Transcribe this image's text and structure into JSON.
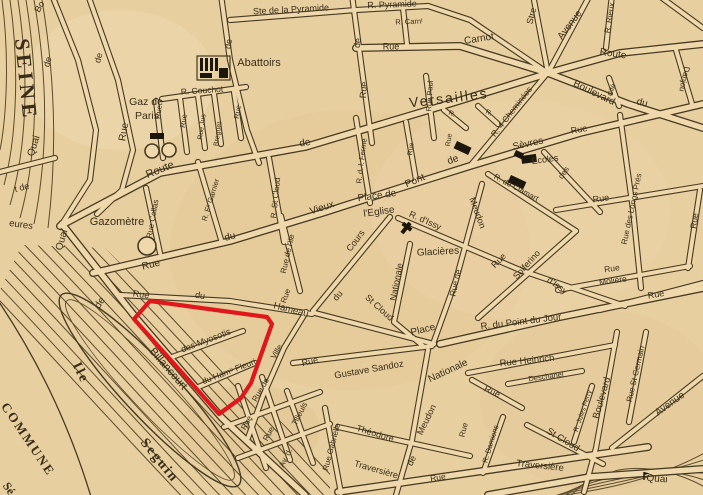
{
  "map": {
    "type": "vintage-street-map",
    "palette": {
      "paper": "#e8cfa0",
      "paper_light": "#efd9ac",
      "ink": "#473a22",
      "label_ink": "#382d18",
      "water_line": "#5b4a2c",
      "highlight_red": "#e0181c",
      "building_black": "#1c170d"
    },
    "highlight": {
      "purpose": "highlighted-parcel",
      "points": [
        [
          150,
          301
        ],
        [
          267,
          317
        ],
        [
          272,
          324
        ],
        [
          251,
          383
        ],
        [
          241,
          398
        ],
        [
          219,
          414
        ],
        [
          134,
          319
        ]
      ]
    },
    "labels": [
      {
        "t": "SEINE",
        "x": 24,
        "y": 80,
        "r": 84,
        "s": 21,
        "f": "serif",
        "b": 1,
        "ls": 4
      },
      {
        "t": "Bo",
        "x": 40,
        "y": 7,
        "r": -60,
        "s": 9
      },
      {
        "t": "de",
        "x": 48,
        "y": 62,
        "r": -74,
        "s": 9
      },
      {
        "t": "Quai",
        "x": 34,
        "y": 146,
        "r": -72,
        "s": 10
      },
      {
        "t": "de",
        "x": 99,
        "y": 58,
        "r": -74,
        "s": 9
      },
      {
        "t": "Rue",
        "x": 124,
        "y": 132,
        "r": -80,
        "s": 10
      },
      {
        "t": "t de",
        "x": 22,
        "y": 188,
        "r": -14,
        "s": 9
      },
      {
        "t": "eures",
        "x": 21,
        "y": 225,
        "r": 8,
        "s": 9.5
      },
      {
        "t": "Quai",
        "x": 62,
        "y": 240,
        "r": -74,
        "s": 10
      },
      {
        "t": "de",
        "x": 100,
        "y": 303,
        "r": -56,
        "s": 10
      },
      {
        "t": "Billancourt",
        "x": 168,
        "y": 369,
        "r": 49,
        "s": 11
      },
      {
        "t": "Ile",
        "x": 80,
        "y": 373,
        "r": 64,
        "s": 14,
        "f": "serif",
        "b": 1,
        "ls": 2
      },
      {
        "t": "Seguin",
        "x": 159,
        "y": 461,
        "r": 51,
        "s": 14,
        "f": "serif",
        "b": 1,
        "ls": 2
      },
      {
        "t": "COMMUNE",
        "x": 27,
        "y": 440,
        "r": 56,
        "s": 13,
        "f": "serif",
        "b": 1,
        "ls": 2
      },
      {
        "t": "Sé",
        "x": 8,
        "y": 489,
        "r": 56,
        "s": 12,
        "f": "serif",
        "b": 1
      },
      {
        "t": "Gaz de",
        "x": 146,
        "y": 102,
        "r": 0,
        "s": 10.5
      },
      {
        "t": "Paris",
        "x": 147,
        "y": 116,
        "r": 0,
        "s": 10.5
      },
      {
        "t": "Gazomètre",
        "x": 117,
        "y": 222,
        "r": 0,
        "s": 11
      },
      {
        "t": "R. Couchot",
        "x": 202,
        "y": 91,
        "r": -4,
        "s": 8.5
      },
      {
        "t": "Rue",
        "x": 159,
        "y": 112,
        "r": -82,
        "s": 7.5
      },
      {
        "t": "Rue",
        "x": 184,
        "y": 121,
        "r": -82,
        "s": 7.5
      },
      {
        "t": "Rue Jus",
        "x": 202,
        "y": 127,
        "r": -82,
        "s": 7
      },
      {
        "t": "Breguet",
        "x": 218,
        "y": 134,
        "r": -82,
        "s": 7
      },
      {
        "t": "Rue",
        "x": 238,
        "y": 112,
        "r": -82,
        "s": 7.5
      },
      {
        "t": "Abattoirs",
        "x": 259,
        "y": 63,
        "r": 0,
        "s": 11
      },
      {
        "t": "de",
        "x": 229,
        "y": 44,
        "r": -82,
        "s": 9
      },
      {
        "t": "Ste de la Pyramide",
        "x": 291,
        "y": 10,
        "r": -3,
        "s": 9
      },
      {
        "t": "R. Pyramide",
        "x": 392,
        "y": 5,
        "r": -2,
        "s": 9
      },
      {
        "t": "R. Carnᵗ",
        "x": 409,
        "y": 22,
        "r": -2,
        "s": 7.5
      },
      {
        "t": "Rue",
        "x": 391,
        "y": 47,
        "r": 0,
        "s": 9
      },
      {
        "t": "Carnot",
        "x": 479,
        "y": 39,
        "r": -9,
        "s": 10
      },
      {
        "t": "de",
        "x": 358,
        "y": 43,
        "r": -82,
        "s": 9
      },
      {
        "t": "Rue",
        "x": 364,
        "y": 90,
        "r": -86,
        "s": 9
      },
      {
        "t": "Rue Paul",
        "x": 430,
        "y": 96,
        "r": -87,
        "s": 7.5
      },
      {
        "t": "Versailles",
        "x": 449,
        "y": 99,
        "r": -7,
        "s": 14,
        "ls": 2
      },
      {
        "t": "Route",
        "x": 160,
        "y": 170,
        "r": -22,
        "s": 11
      },
      {
        "t": "de",
        "x": 305,
        "y": 143,
        "r": -9,
        "s": 10
      },
      {
        "t": "Stre",
        "x": 532,
        "y": 16,
        "r": -76,
        "s": 9
      },
      {
        "t": "Avenue",
        "x": 570,
        "y": 25,
        "r": -53,
        "s": 10
      },
      {
        "t": "R. Rieux",
        "x": 610,
        "y": 18,
        "r": -81,
        "s": 8
      },
      {
        "t": "Route",
        "x": 613,
        "y": 54,
        "r": 8,
        "s": 10
      },
      {
        "t": "Boulevard",
        "x": 594,
        "y": 93,
        "r": 26,
        "s": 10
      },
      {
        "t": "du",
        "x": 642,
        "y": 103,
        "r": 15,
        "s": 10
      },
      {
        "t": "Cité",
        "x": 612,
        "y": 90,
        "r": -72,
        "s": 7
      },
      {
        "t": "Danjou",
        "x": 684,
        "y": 79,
        "r": 102,
        "s": 8
      },
      {
        "t": "R. 4 Cheminées",
        "x": 512,
        "y": 112,
        "r": -52,
        "s": 8.5
      },
      {
        "t": "Sèvres",
        "x": 528,
        "y": 144,
        "r": -12,
        "s": 10
      },
      {
        "t": "Rue",
        "x": 579,
        "y": 130,
        "r": -10,
        "s": 9
      },
      {
        "t": "des",
        "x": 564,
        "y": 173,
        "r": -56,
        "s": 8
      },
      {
        "t": "Ecoles",
        "x": 545,
        "y": 160,
        "r": -8,
        "s": 9
      },
      {
        "t": "R. de Clamart",
        "x": 516,
        "y": 188,
        "r": 28,
        "s": 8
      },
      {
        "t": "R. d. l. Ferme",
        "x": 362,
        "y": 161,
        "r": -83,
        "s": 7.5
      },
      {
        "t": "Rue",
        "x": 411,
        "y": 149,
        "r": -83,
        "s": 7
      },
      {
        "t": "R.",
        "x": 452,
        "y": 114,
        "r": 25,
        "s": 7
      },
      {
        "t": "R.",
        "x": 489,
        "y": 113,
        "r": 25,
        "s": 7
      },
      {
        "t": "Rue",
        "x": 449,
        "y": 140,
        "r": -81,
        "s": 7
      },
      {
        "t": "Place de",
        "x": 377,
        "y": 196,
        "r": -8,
        "s": 10
      },
      {
        "t": "l'Eglise",
        "x": 379,
        "y": 212,
        "r": -8,
        "s": 10
      },
      {
        "t": "Vieux",
        "x": 322,
        "y": 208,
        "r": -18,
        "s": 10
      },
      {
        "t": "Pont",
        "x": 415,
        "y": 181,
        "r": -23,
        "s": 10
      },
      {
        "t": "de",
        "x": 453,
        "y": 160,
        "r": -20,
        "s": 10
      },
      {
        "t": "Rue",
        "x": 151,
        "y": 265,
        "r": -13,
        "s": 10
      },
      {
        "t": "du",
        "x": 230,
        "y": 237,
        "r": -14,
        "s": 10
      },
      {
        "t": "R. St Cloud",
        "x": 276,
        "y": 198,
        "r": -84,
        "s": 8
      },
      {
        "t": "Rue Collas",
        "x": 153,
        "y": 219,
        "r": -80,
        "s": 8
      },
      {
        "t": "R. Fˢ Garnier",
        "x": 211,
        "y": 200,
        "r": -73,
        "s": 7.5
      },
      {
        "t": "Rue de l'Ile",
        "x": 288,
        "y": 254,
        "r": -77,
        "s": 8
      },
      {
        "t": "du",
        "x": 338,
        "y": 296,
        "r": -50,
        "s": 9
      },
      {
        "t": "Cours",
        "x": 356,
        "y": 241,
        "r": -53,
        "s": 9
      },
      {
        "t": "Rue",
        "x": 141,
        "y": 295,
        "r": 8,
        "s": 9
      },
      {
        "t": "du",
        "x": 200,
        "y": 296,
        "r": 8,
        "s": 9
      },
      {
        "t": "Hameau",
        "x": 291,
        "y": 310,
        "r": 14,
        "s": 9.5
      },
      {
        "t": "Rue",
        "x": 286,
        "y": 296,
        "r": -70,
        "s": 8
      },
      {
        "t": "des Myosotis",
        "x": 206,
        "y": 341,
        "r": -21,
        "s": 9
      },
      {
        "t": "du Hamᵘ Fleuri",
        "x": 229,
        "y": 372,
        "r": -21,
        "s": 8.5
      },
      {
        "t": "Ville",
        "x": 277,
        "y": 352,
        "r": -60,
        "s": 8
      },
      {
        "t": "Rue de",
        "x": 261,
        "y": 390,
        "r": -60,
        "s": 8
      },
      {
        "t": "St Cloud",
        "x": 379,
        "y": 308,
        "r": 42,
        "s": 9
      },
      {
        "t": "Rue",
        "x": 310,
        "y": 362,
        "r": -14,
        "s": 9
      },
      {
        "t": "Gustave Sandoz",
        "x": 369,
        "y": 370,
        "r": -10,
        "s": 9.5
      },
      {
        "t": "Place",
        "x": 423,
        "y": 330,
        "r": -14,
        "s": 10
      },
      {
        "t": "Nationale",
        "x": 448,
        "y": 371,
        "r": -25,
        "s": 10
      },
      {
        "t": "Nationale",
        "x": 397,
        "y": 282,
        "r": -79,
        "s": 9
      },
      {
        "t": "Glacières",
        "x": 438,
        "y": 252,
        "r": -3,
        "s": 10
      },
      {
        "t": "R. d'Issy",
        "x": 425,
        "y": 221,
        "r": 24,
        "s": 9
      },
      {
        "t": "d'Issy",
        "x": 557,
        "y": 286,
        "r": 36,
        "s": 9
      },
      {
        "t": "Rue",
        "x": 499,
        "y": 261,
        "r": -45,
        "s": 9
      },
      {
        "t": "Solferino",
        "x": 527,
        "y": 265,
        "r": -48,
        "s": 9
      },
      {
        "t": "Rue de",
        "x": 456,
        "y": 283,
        "r": -77,
        "s": 8.5
      },
      {
        "t": "Meudon",
        "x": 477,
        "y": 213,
        "r": 70,
        "s": 9
      },
      {
        "t": "Meudon",
        "x": 427,
        "y": 420,
        "r": -64,
        "s": 9
      },
      {
        "t": "de",
        "x": 412,
        "y": 461,
        "r": -64,
        "s": 9
      },
      {
        "t": "R. du Point du Jour",
        "x": 521,
        "y": 322,
        "r": -7,
        "s": 9.5
      },
      {
        "t": "Rue Heinrich",
        "x": 527,
        "y": 361,
        "r": -6,
        "s": 9.5
      },
      {
        "t": "Deschanel",
        "x": 546,
        "y": 377,
        "r": -8,
        "s": 7.5
      },
      {
        "t": "Rue",
        "x": 492,
        "y": 392,
        "r": 25,
        "s": 9
      },
      {
        "t": "Rue",
        "x": 464,
        "y": 430,
        "r": -76,
        "s": 8
      },
      {
        "t": "R. Damiens",
        "x": 491,
        "y": 444,
        "r": -73,
        "s": 7.5
      },
      {
        "t": "St Cloud",
        "x": 563,
        "y": 440,
        "r": 31,
        "s": 9.5
      },
      {
        "t": "R. Jules Ferry",
        "x": 583,
        "y": 411,
        "r": -71,
        "s": 7
      },
      {
        "t": "Boulevard",
        "x": 602,
        "y": 398,
        "r": -74,
        "s": 9.5
      },
      {
        "t": "Rue St Germain",
        "x": 636,
        "y": 374,
        "r": -77,
        "s": 8
      },
      {
        "t": "Avenue",
        "x": 670,
        "y": 404,
        "r": -36,
        "s": 10
      },
      {
        "t": "Traversière",
        "x": 540,
        "y": 466,
        "r": 6,
        "s": 9.5
      },
      {
        "t": "Traversière",
        "x": 376,
        "y": 470,
        "r": 16,
        "s": 9
      },
      {
        "t": "Théodore",
        "x": 375,
        "y": 434,
        "r": 17,
        "s": 9
      },
      {
        "t": "Rue Gabrielle",
        "x": 332,
        "y": 447,
        "r": -75,
        "s": 8
      },
      {
        "t": "Tilleuls",
        "x": 300,
        "y": 414,
        "r": -63,
        "s": 8
      },
      {
        "t": "Av. d.",
        "x": 286,
        "y": 458,
        "r": -63,
        "s": 8
      },
      {
        "t": "Rue",
        "x": 247,
        "y": 423,
        "r": -62,
        "s": 8
      },
      {
        "t": "Rue",
        "x": 269,
        "y": 434,
        "r": -62,
        "s": 8
      },
      {
        "t": "Rue",
        "x": 438,
        "y": 478,
        "r": -8,
        "s": 8.5
      },
      {
        "t": "Rue",
        "x": 601,
        "y": 199,
        "r": -8,
        "s": 9
      },
      {
        "t": "Rue des Longs Prés",
        "x": 632,
        "y": 209,
        "r": -78,
        "s": 8
      },
      {
        "t": "Rue",
        "x": 612,
        "y": 269,
        "r": -8,
        "s": 8.5
      },
      {
        "t": "Molière",
        "x": 613,
        "y": 281,
        "r": -8,
        "s": 8.5
      },
      {
        "t": "Rue",
        "x": 695,
        "y": 221,
        "r": -81,
        "s": 8.5
      },
      {
        "t": "Rue",
        "x": 656,
        "y": 295,
        "r": -10,
        "s": 9
      },
      {
        "t": "Quai",
        "x": 657,
        "y": 479,
        "r": 4,
        "s": 10
      }
    ],
    "symbols": [
      {
        "type": "gas-holder",
        "x": 152,
        "y": 151,
        "r": 7
      },
      {
        "type": "gas-holder",
        "x": 169,
        "y": 150,
        "r": 7
      },
      {
        "type": "gas-holder",
        "x": 147,
        "y": 246,
        "r": 9
      },
      {
        "type": "building-block",
        "x": 150,
        "y": 133,
        "w": 14,
        "h": 6,
        "rot": 0
      },
      {
        "type": "abattoirs-building",
        "x": 197,
        "y": 56,
        "w": 33,
        "h": 24
      },
      {
        "type": "church-cross",
        "x": 406,
        "y": 228,
        "size": 13,
        "rot": 38
      },
      {
        "type": "building-block",
        "x": 521,
        "y": 156,
        "w": 15,
        "h": 8,
        "rot": -8
      },
      {
        "type": "building-block",
        "x": 511,
        "y": 175,
        "w": 17,
        "h": 8,
        "rot": 25
      },
      {
        "type": "building-block",
        "x": 457,
        "y": 141,
        "w": 16,
        "h": 8,
        "rot": 25
      },
      {
        "type": "building-block",
        "x": 516,
        "y": 150,
        "w": 9,
        "h": 6,
        "rot": 25
      },
      {
        "type": "quai-flag",
        "x": 644,
        "y": 477
      }
    ]
  }
}
